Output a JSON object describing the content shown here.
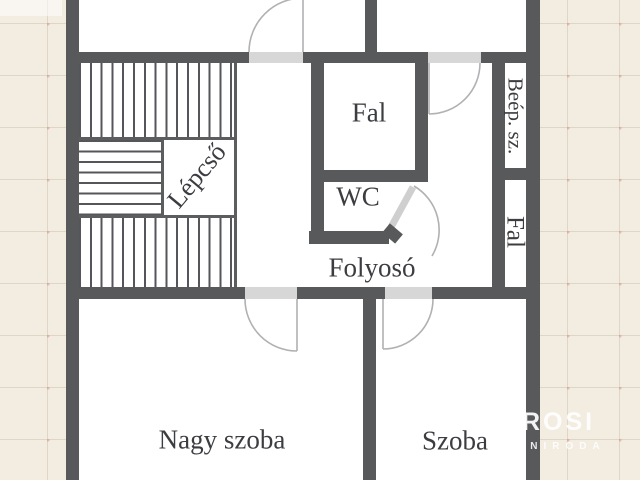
{
  "colors": {
    "background": "#f2ece1",
    "wall": "#58595b",
    "room_fill": "#ffffff",
    "door_threshold": "#d7d7d7",
    "door_swing": "#b0b1b3",
    "door_leaf_wc": "#cfcfcf",
    "stair_hatch_line": "#55565a",
    "label_text": "#3b3d40",
    "watermark": "#ffffff"
  },
  "rooms": {
    "stairs": "Lépcső",
    "wall_block_top": "Fal",
    "wc": "WC",
    "corridor": "Folyosó",
    "built_in_closet": "Beép. sz.",
    "wall_block_right": "Fal",
    "big_room": "Nagy szoba",
    "room": "Szoba"
  },
  "watermark": {
    "brand": "ROSI",
    "subtitle": "ANIRODA"
  }
}
